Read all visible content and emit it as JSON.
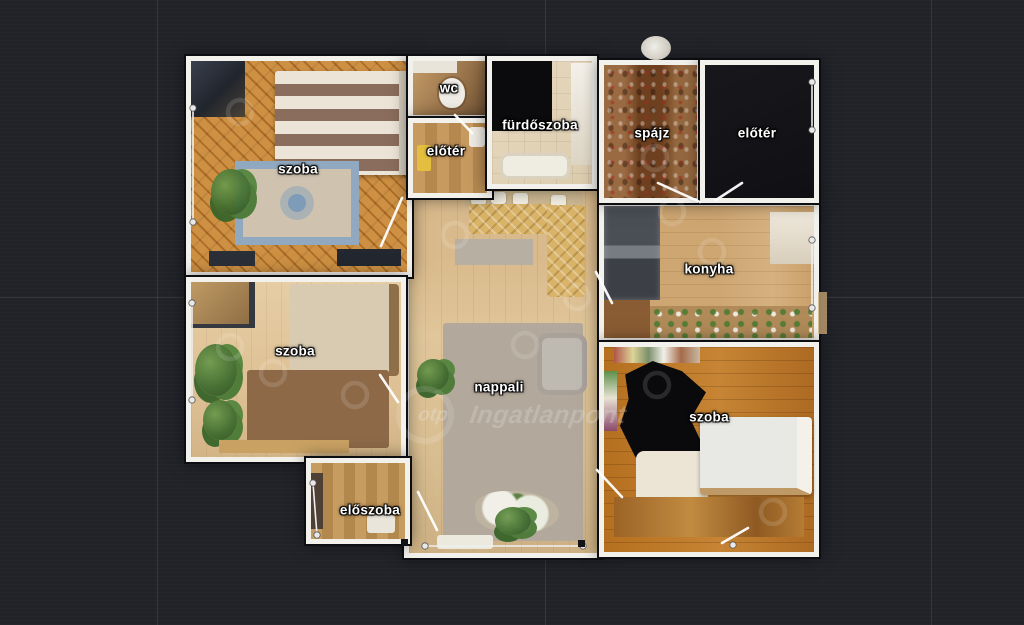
{
  "palette": {
    "background": "#212329",
    "grid_line": "rgba(255,255,255,0.09)",
    "wall": "#f3f1ec",
    "wall_seam": "#0d0e11",
    "label_text": "#ffffff"
  },
  "floorplan": {
    "type": "apartment 3D top-down floor plan",
    "rooms": {
      "bedroom_top_left": {
        "label": "szoba"
      },
      "wc": {
        "label": "wc"
      },
      "bathroom": {
        "label": "fürdőszoba"
      },
      "hallway_small": {
        "label": "előtér"
      },
      "pantry": {
        "label": "spájz"
      },
      "foyer_top_right": {
        "label": "előtér"
      },
      "kitchen": {
        "label": "konyha"
      },
      "bedroom_middle_left": {
        "label": "szoba"
      },
      "living_room": {
        "label": "nappali"
      },
      "bedroom_right": {
        "label": "szoba"
      },
      "entrance_hall": {
        "label": "előszoba"
      }
    }
  },
  "watermark": {
    "logo": "otp",
    "brand": "Ingatlanpont"
  }
}
